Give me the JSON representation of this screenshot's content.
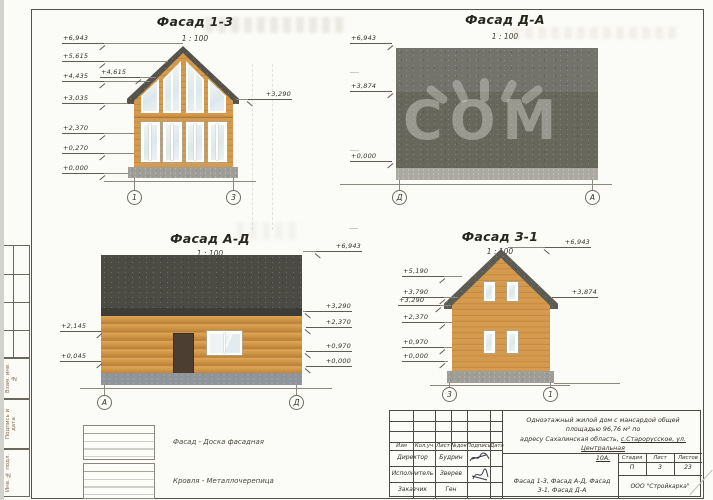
{
  "facade_13": {
    "title": "Фасад 1-3",
    "scale": "1 : 100",
    "axis_left": "1",
    "axis_right": "3",
    "elev": {
      "e6943": "+6,943",
      "e5615": "+5,615",
      "e4435": "+4,435",
      "e4615": "+4,615",
      "e3035": "+3,035",
      "e2370": "+2,370",
      "e0270": "+0,270",
      "e0000": "+0,000",
      "e3290": "+3,290"
    }
  },
  "facade_da": {
    "title": "Фасад Д-А",
    "scale": "1 : 100",
    "axis_left": "Д",
    "axis_right": "А",
    "elev": {
      "e6943": "+6,943",
      "e3874": "+3,874",
      "e0000": "+0,000"
    }
  },
  "facade_ad": {
    "title": "Фасад А-Д",
    "scale": "1 : 100",
    "axis_left": "А",
    "axis_right": "Д",
    "elev": {
      "e2145": "+2,145",
      "e0045": "+0,045",
      "e6943": "+6,943",
      "e3290": "+3,290",
      "e2370": "+2,370",
      "e0970": "+0,970",
      "e0000": "+0,000"
    }
  },
  "facade_31": {
    "title": "Фасад З-1",
    "scale": "1 : 100",
    "axis_left": "3",
    "axis_right": "1",
    "elev": {
      "e5190": "+5,190",
      "e3790": "+3,790",
      "e3290": "+3,290",
      "e2370": "+2,370",
      "e0970": "+0,970",
      "e0000": "+0,000",
      "e6943": "+6,943",
      "e3874": "+3,874"
    }
  },
  "legend": {
    "item1": "Фасад - Доска фасадная",
    "item2": "Кровля - Металлочерепица"
  },
  "title_block": {
    "description_line1": "Одноэтажный жилой дом с мансардой общей площадью 96,76 м² по",
    "description_line2a": "адресу Сахалинская область, ",
    "description_line2b": "с.Старорусское, ул. Центральная",
    "description_line3": "10А.",
    "col_izm": "Изм",
    "col_koluch": "Кол.уч",
    "col_list": "Лист",
    "col_ndok": "№док",
    "col_podpis": "Подпись",
    "col_data": "Дата",
    "row1_role": "Директор",
    "row1_name": "Будрин",
    "row2_role": "Исполнитель",
    "row2_name": "Зверев",
    "row3_role": "Заказчик",
    "row3_name": "Ген",
    "stage_label": "Стадия",
    "list_label": "Лист",
    "listov_label": "Листов",
    "stage": "П",
    "list": "3",
    "listov": "23",
    "drawing_title": "Фасад 1-3, Фасад А-Д, Фасад З-1, Фасад Д-А",
    "company": "ООО \"Стройкарка\""
  },
  "side_stamp": {
    "s1": "Взам. инв. №",
    "s2": "Подпись и дата",
    "s3": "Инв. № подл."
  },
  "watermark": "COM"
}
